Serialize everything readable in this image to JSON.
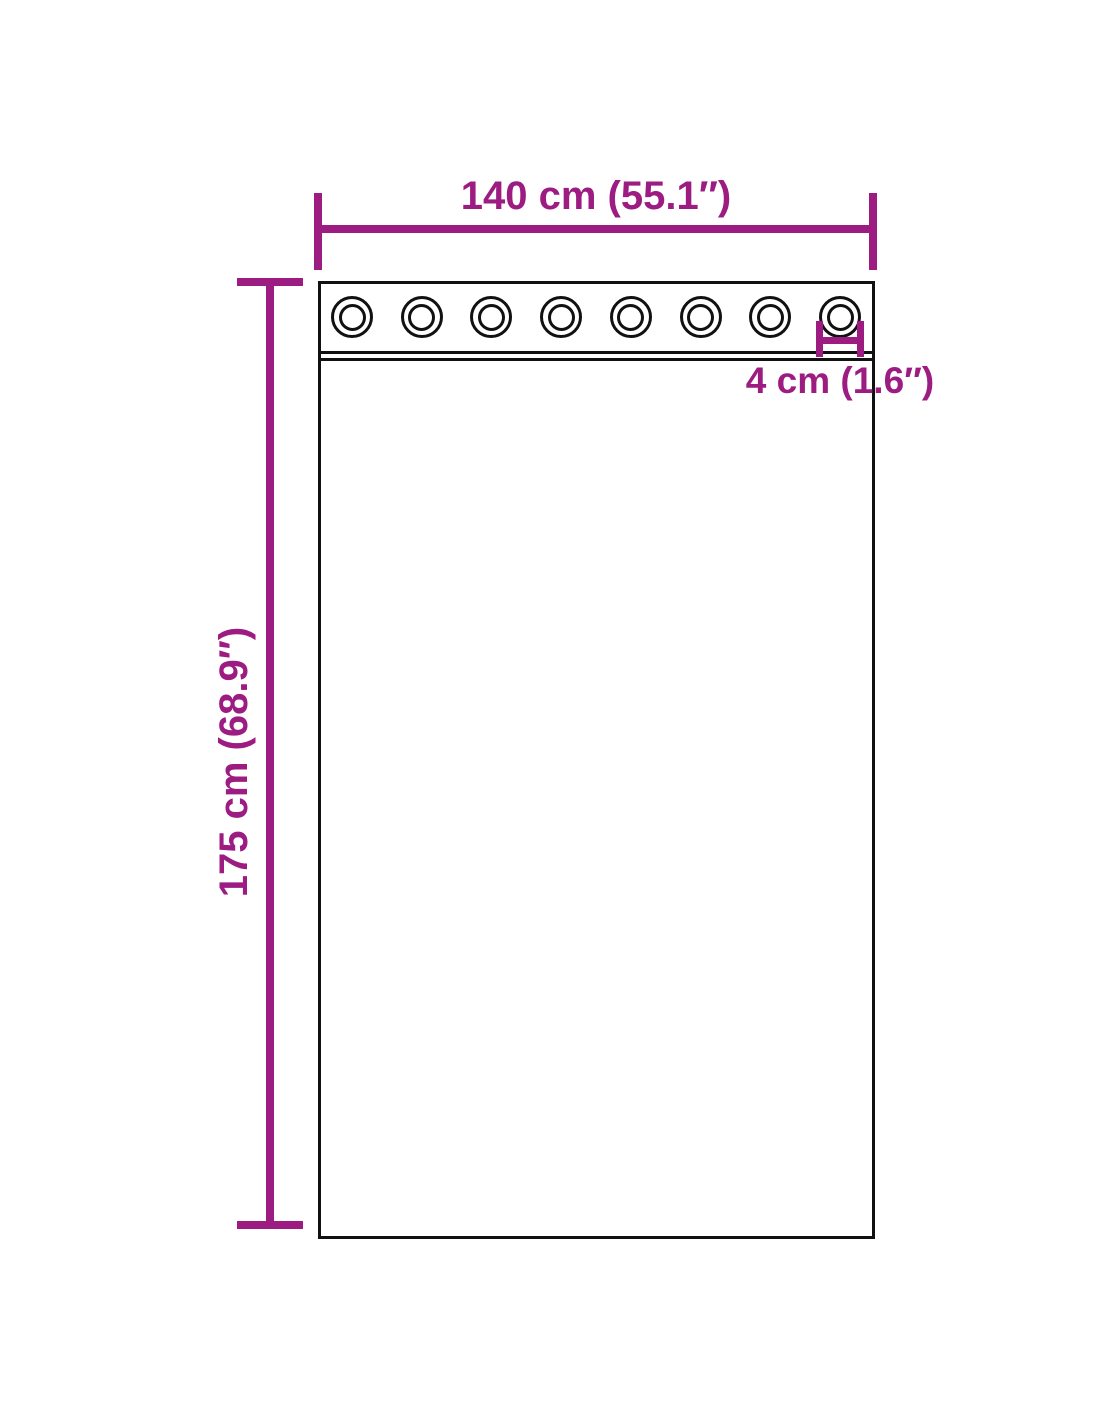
{
  "diagram": {
    "product": "grommet-curtain-dimension-diagram",
    "dimensions": {
      "width": {
        "label": "140 cm (55.1″)"
      },
      "height": {
        "label": "175 cm (68.9″)"
      },
      "grommet": {
        "label": "4 cm (1.6″)"
      }
    },
    "grommets": {
      "count": 8
    },
    "colors": {
      "dimension_accent": "#9C1C82",
      "outline": "#111111",
      "background": "#FFFFFF"
    }
  }
}
